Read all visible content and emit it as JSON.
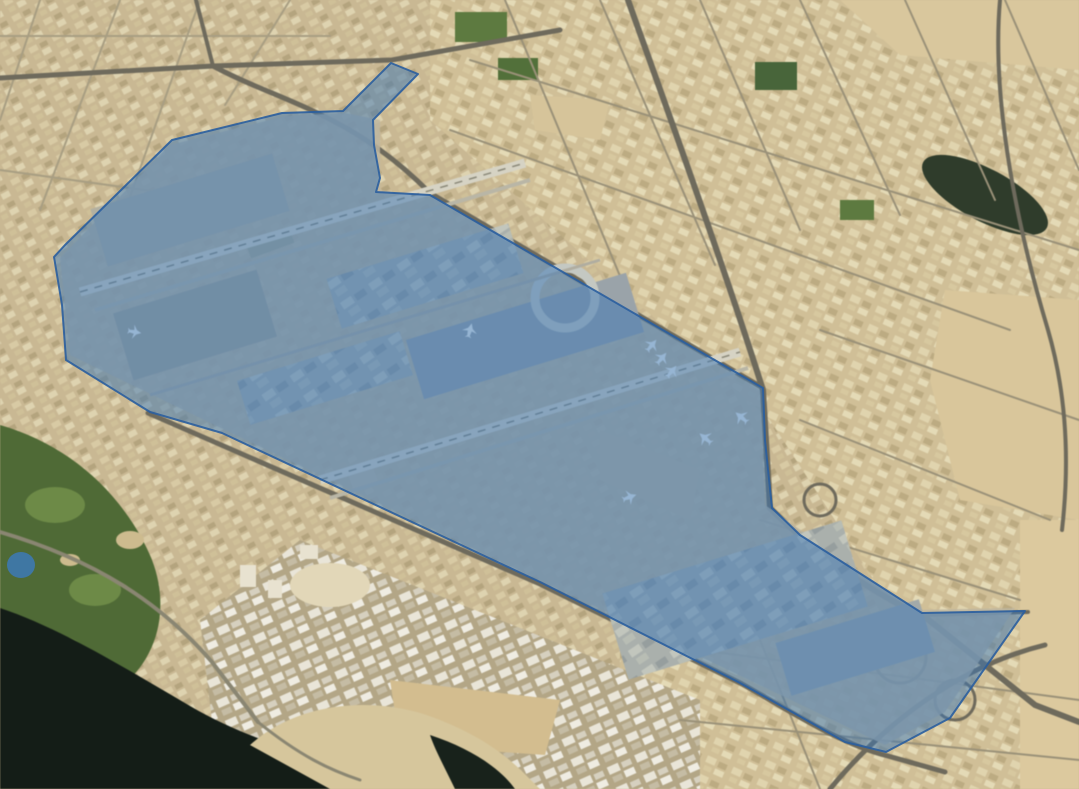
{
  "map": {
    "view_type": "satellite-imagery",
    "overlay": {
      "region_polygon": {
        "semantic": "highlighted airport area polygon",
        "points": "391,63 418,74 373,120 374,145 380,178 376,192 430,195 763,388 765,440 772,508 800,535 922,613 1025,611 950,718 886,752 845,742 792,712 740,683 540,582 222,433 150,412 66,360 62,305 54,257 65,245 172,140 282,113 343,111",
        "fill": "#3a76b5",
        "fill_opacity": "0.5",
        "stroke": "#2a5e9e",
        "stroke_width": "2",
        "stroke_opacity": "0.9"
      },
      "dot_marker": {
        "semantic": "small circular highlighted area",
        "cx": "21",
        "cy": "565",
        "rx": "14",
        "ry": "13",
        "fill": "#3d79b3",
        "opacity": "0.88"
      }
    }
  }
}
